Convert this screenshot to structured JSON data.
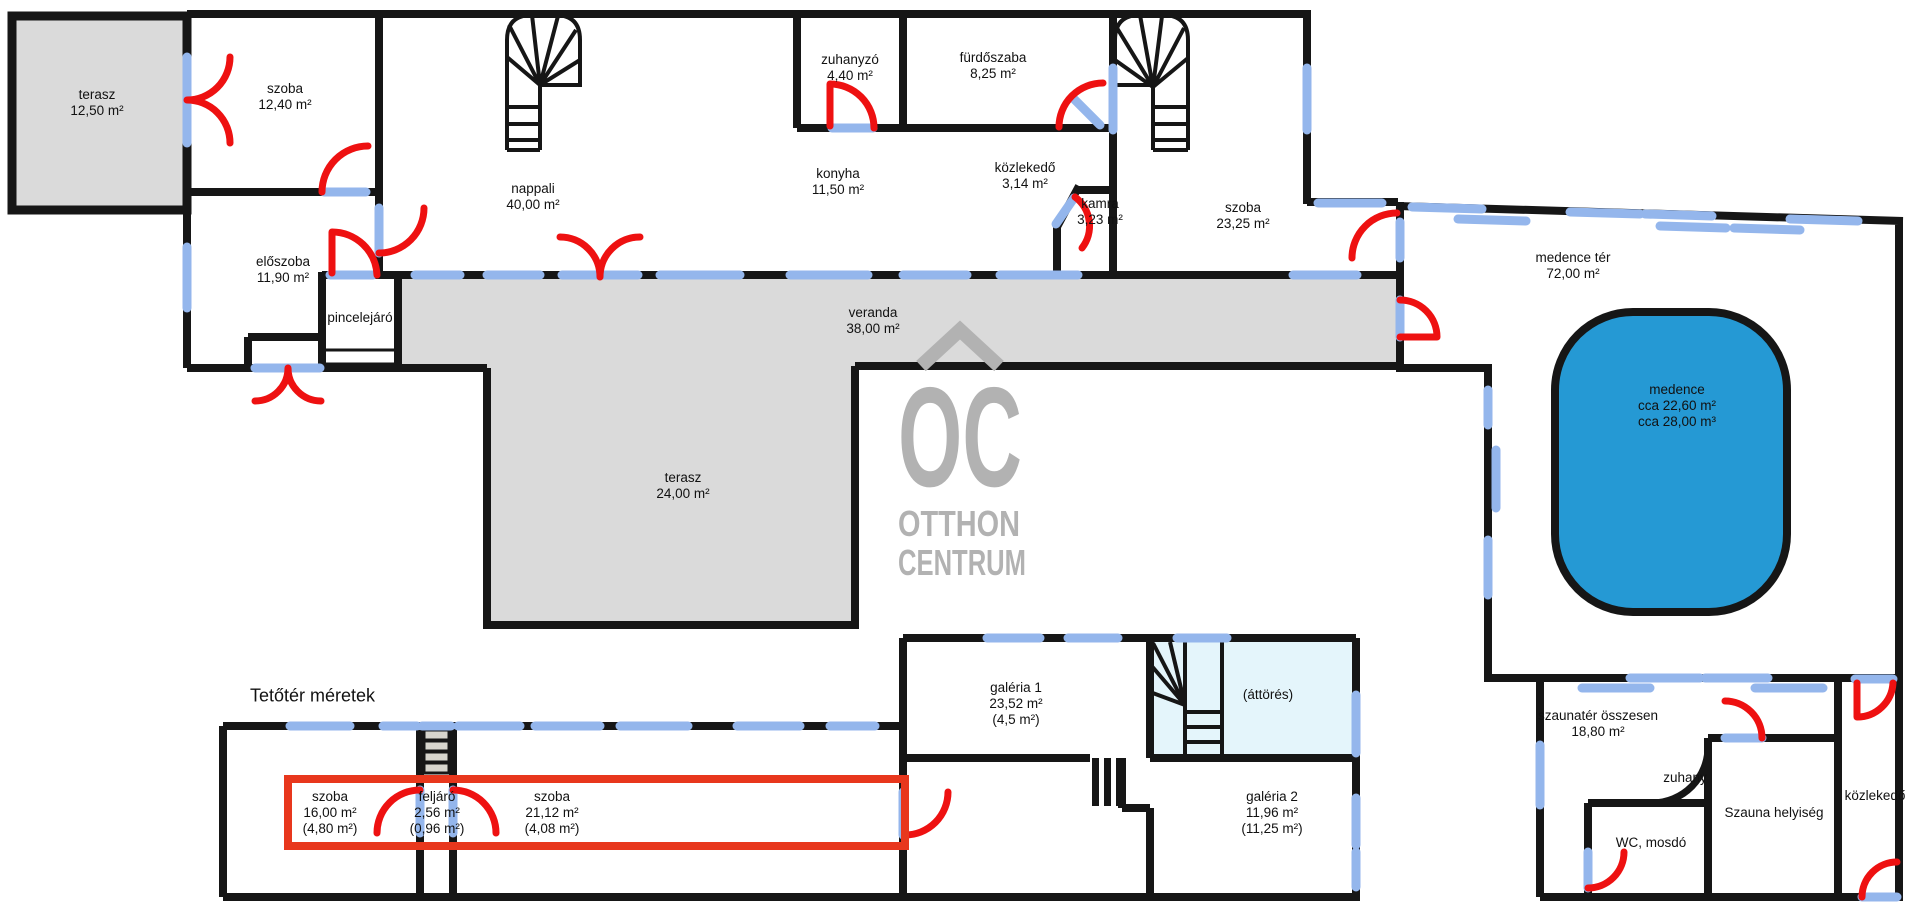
{
  "colors": {
    "wall": "#161616",
    "window_blue": "#94b6ec",
    "door_red": "#ee1111",
    "highlight_red": "#e8371d",
    "terrace_gray": "#dadada",
    "pool_blue": "#2599d4",
    "opening_lightblue": "#e4f5fb",
    "stair_tread": "#d7d5cd",
    "logo_gray": "#b2b2b2"
  },
  "heading": {
    "text": "Tetőtér méretek"
  },
  "logo": {
    "initials": "OC",
    "line1": "OTTHON",
    "line2": "CENTRUM"
  },
  "labels": [
    {
      "id": "terasz-felso",
      "text": "terasz\n12,50 m²"
    },
    {
      "id": "szoba-1240",
      "text": "szoba\n12,40 m²"
    },
    {
      "id": "eloszoba",
      "text": "előszoba\n11,90 m²"
    },
    {
      "id": "pincelejaro",
      "text": "pincelejáró"
    },
    {
      "id": "nappali",
      "text": "nappali\n40,00 m²"
    },
    {
      "id": "zuhanyzo",
      "text": "zuhanyzó\n4,40 m²"
    },
    {
      "id": "furdoszaba",
      "text": "fürdőszaba\n8,25 m²"
    },
    {
      "id": "konyha",
      "text": "konyha\n11,50 m²"
    },
    {
      "id": "kozlekedo-felso",
      "text": "közlekedő\n3,14 m²"
    },
    {
      "id": "kamra",
      "text": "kamra\n3,23 m²"
    },
    {
      "id": "szoba-2325",
      "text": "szoba\n23,25 m²"
    },
    {
      "id": "medence-ter",
      "text": "medence tér\n72,00 m²"
    },
    {
      "id": "medence",
      "text": "medence\ncca 22,60 m²\ncca 28,00 m³"
    },
    {
      "id": "veranda",
      "text": "veranda\n38,00 m²"
    },
    {
      "id": "terasz-also",
      "text": "terasz\n24,00 m²"
    },
    {
      "id": "tetoter-szoba-1",
      "text": "szoba\n16,00 m²\n(4,80 m²)"
    },
    {
      "id": "feljaro",
      "text": "feljáró\n2,56 m²\n(0,96 m²)"
    },
    {
      "id": "tetoter-szoba-2",
      "text": "szoba\n21,12 m²\n(4,08 m²)"
    },
    {
      "id": "galeria-1",
      "text": "galéria 1\n23,52 m²\n(4,5 m²)"
    },
    {
      "id": "attores",
      "text": "(áttörés)"
    },
    {
      "id": "galeria-2",
      "text": "galéria 2\n11,96 m²\n(11,25 m²)"
    },
    {
      "id": "szaunater",
      "text": "szaunatér összesen\n18,80 m²"
    },
    {
      "id": "zuhany",
      "text": "zuhany"
    },
    {
      "id": "wc-mosdo",
      "text": "WC, mosdó"
    },
    {
      "id": "szauna-helyiseg",
      "text": "Szauna helyiség"
    },
    {
      "id": "kozlekedo-also",
      "text": "közlekedő"
    }
  ]
}
